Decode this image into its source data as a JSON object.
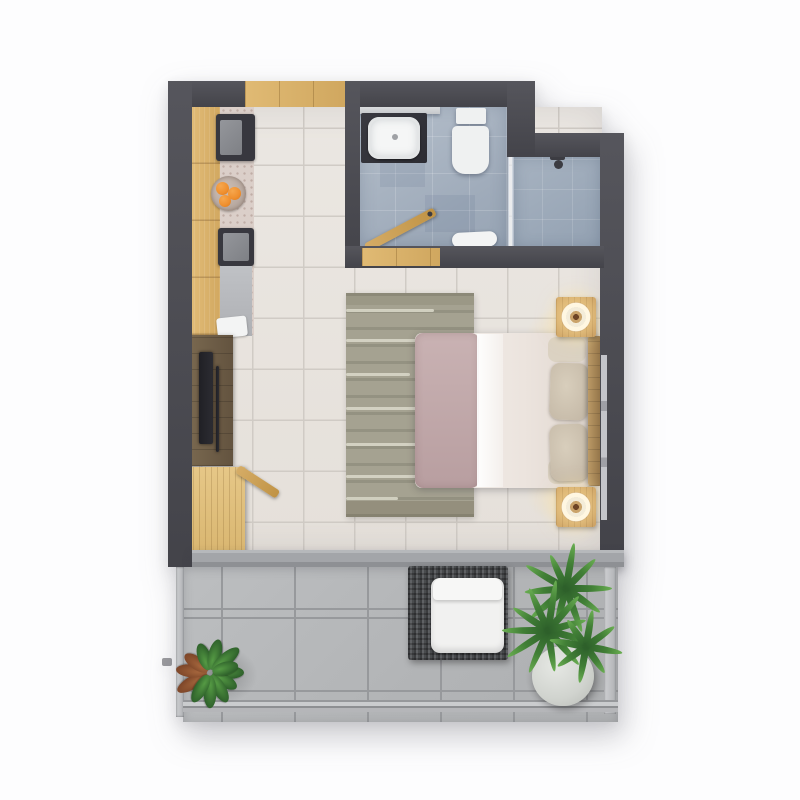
{
  "meta": {
    "scene": "top-down 3d rendered floor plan of a studio apartment",
    "text_labels": []
  },
  "palette": {
    "background": "#fdfdfe",
    "wall": "#4b4b52",
    "bedroomTile": "#eae6e0",
    "bedroomGrout": "#d0cbc5",
    "bathTile": "#a9b6c3",
    "showerTile": "#9dabbb",
    "balconyTile": "#b7b9bb",
    "balconyGrout": "#97999c",
    "woodLight": "#dcb672",
    "woodTan": "#c9a15c",
    "woodNight": "#c3965a",
    "woodWalnut": "#6f5f48",
    "marble": "#dbcfc9",
    "applianceDark": "#38383f",
    "sinkWhite": "#f5f6f6",
    "toiletWhite": "#eff1f1",
    "rugBase": "#a5a291",
    "rugLine": "#dbd9ca",
    "blanket": "#b89ea0",
    "pillow": "#c2b6a4",
    "chairDark": "#55575a",
    "cushion": "#f1f1f0",
    "plantDark": "#2d5f2a",
    "plantMid": "#417f36",
    "plantLight": "#6aae52",
    "plantBrown": "#7c4528",
    "pot": "#d0d3ce",
    "towel": "#f3f4f4",
    "orange": "#ef8f2e"
  },
  "rooms": [
    {
      "name": "kitchen",
      "fixtures": [
        "wood-cabinets",
        "marble-counter",
        "cooktop",
        "fruit-bowl",
        "kitchen-sink",
        "counter-towel"
      ]
    },
    {
      "name": "bathroom",
      "fixtures": [
        "vanity",
        "wash-basin",
        "toilet",
        "shower",
        "shower-glass",
        "bath-mat",
        "swing-door",
        "shelf"
      ]
    },
    {
      "name": "bedroom-living",
      "fixtures": [
        "double-bed",
        "headboard",
        "pillows",
        "striped-rug",
        "nightstand-left",
        "nightstand-right",
        "table-lamps",
        "tv-console",
        "tv",
        "desk",
        "desk-chair"
      ]
    },
    {
      "name": "balcony",
      "fixtures": [
        "outdoor-chair",
        "chair-cushion",
        "potted-plant",
        "palm-plants",
        "planter-pot",
        "railing"
      ]
    }
  ],
  "openings": [
    "kitchen-window-top-wall",
    "bedroom-window-right-wall",
    "bathroom-doorway",
    "sliding-glass-door-to-balcony"
  ]
}
